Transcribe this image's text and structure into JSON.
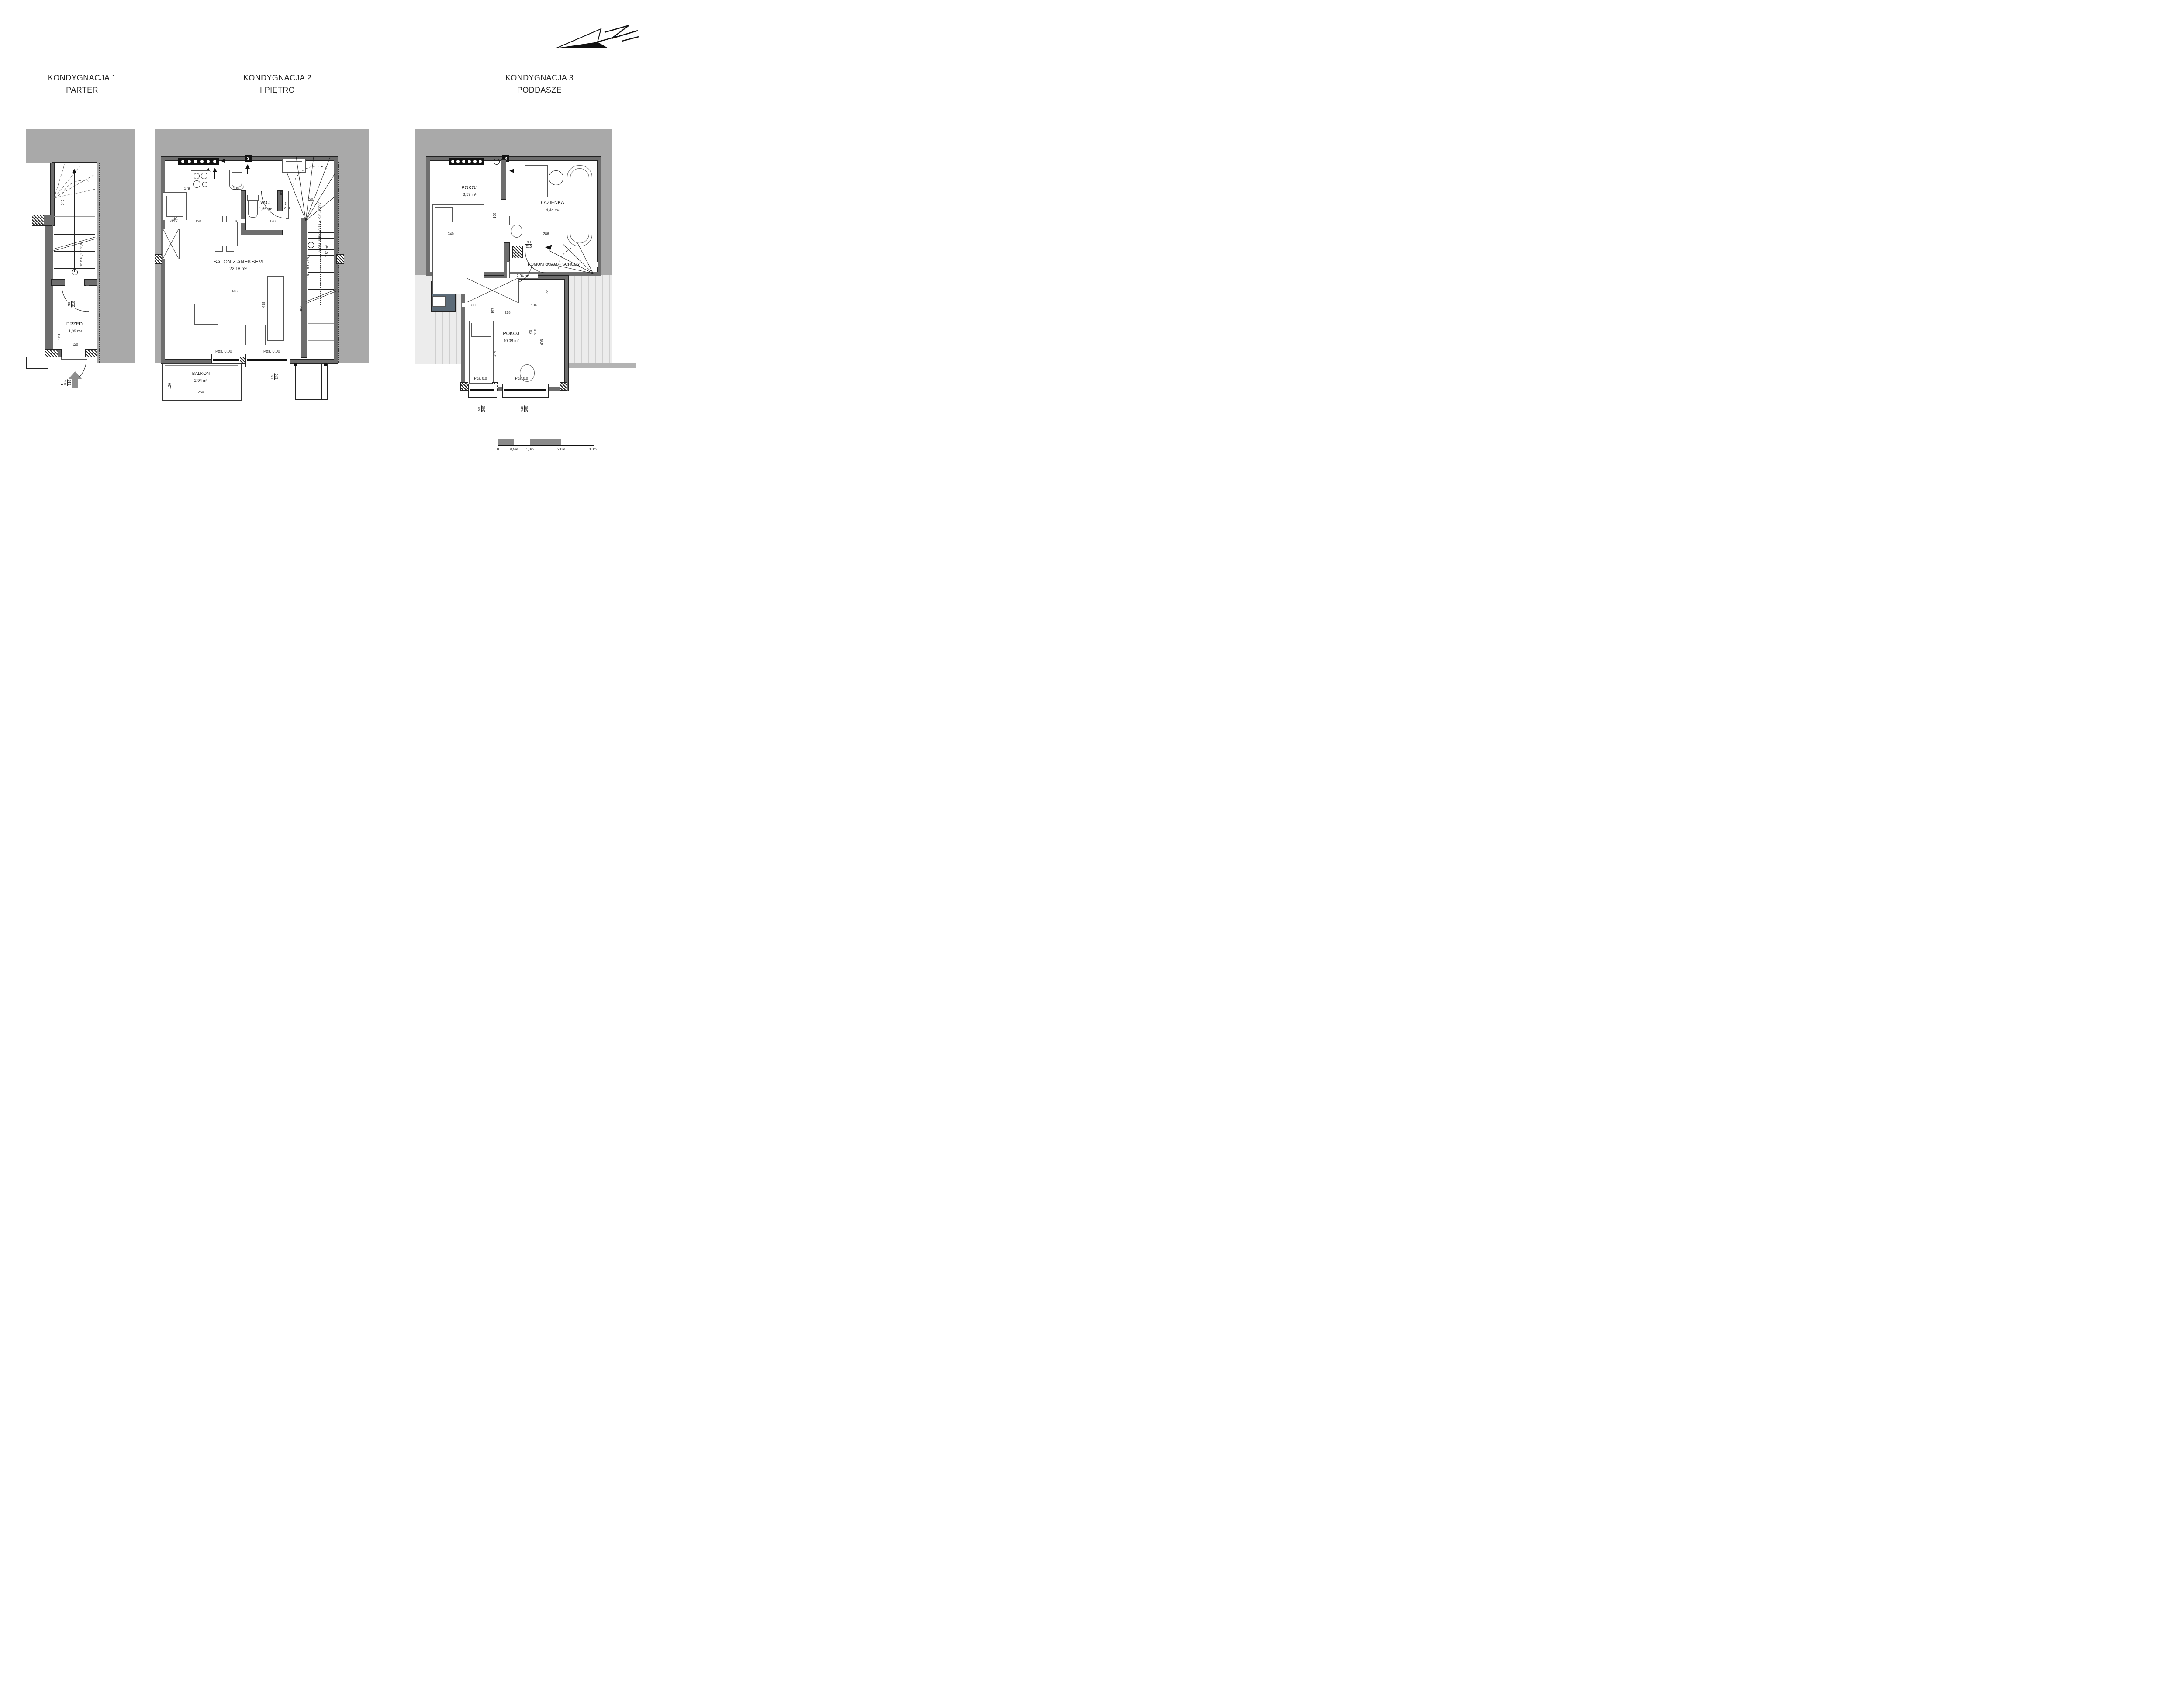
{
  "colors": {
    "neighbor_gray": "#a9a9a9",
    "wall_gray": "#6e6e6e",
    "roof_gray": "#ececec",
    "accent_slate": "#5c6b78"
  },
  "icons": {
    "heater_glyph": "✳"
  },
  "floor1": {
    "title_line1": "KONDYGNACJA 1",
    "title_line2": "PARTER",
    "room": {
      "name": "PRZED.",
      "area": "1,39 m²"
    },
    "dims": {
      "door_top_num": "90",
      "door_top_den": "210",
      "room_width": "120",
      "room_height": "120",
      "entry_num": "105",
      "entry_den": "210",
      "stair_run": "16 x 18,1 x 23,8",
      "stair_width": "140"
    }
  },
  "floor2": {
    "title_line1": "KONDYGNACJA 2",
    "title_line2": "I PIĘTRO",
    "section_marker": "3",
    "rooms": {
      "wc": {
        "name": "W.C.",
        "area": "1,56 m²"
      },
      "salon": {
        "name": "SALON Z ANEKSEM",
        "area": "22,18 m²"
      },
      "komunikacja": {
        "name": "KOMUNIKACJA + SCHODY",
        "area": "7,51 m²"
      },
      "balkon": {
        "name": "BALKON",
        "area": "2,94 m²"
      }
    },
    "level_note": "Pos. 0,00",
    "dims": {
      "kitchen": "179",
      "sink": "100",
      "top_right": "120",
      "wc_door_num": "90",
      "wc_door_den": "210",
      "wc_side": "160",
      "row": [
        "60",
        "120",
        "116",
        "120"
      ],
      "salon_width": "416",
      "salon_depth": "387",
      "table": "459",
      "stair_run": "16 x 18,1 x 23,8",
      "balkon_width": "250",
      "balkon_depth": "120",
      "door_win_num": "90",
      "door_win_den": "240",
      "win_num": "140",
      "win_den": "240"
    }
  },
  "floor3": {
    "title_line1": "KONDYGNACJA 3",
    "title_line2": "PODDASZE",
    "section_marker": "3",
    "rooms": {
      "pokoj1": {
        "name": "POKÓJ",
        "area": "8,59 m²"
      },
      "lazienka": {
        "name": "ŁAZIENKA",
        "area": "4,44 m²"
      },
      "komunikacja": {
        "name": "KOMUNIKACJA + SCHODY",
        "area": "7,04 m²"
      },
      "pokoj2": {
        "name": "POKÓJ",
        "area": "10,08 m²"
      }
    },
    "level_note": "Pos. 0,0",
    "dims": {
      "bed_width": "340",
      "mid_height": "168",
      "bath_width": "286",
      "door1_num": "90",
      "door1_den": "210",
      "corridor_1": "300",
      "corridor_2": "106",
      "v1": "135",
      "v2": "197",
      "door2_num": "90",
      "door2_den": "210",
      "door3_num": "90",
      "door3_den": "210",
      "lower_width": "278",
      "lower_height": "406",
      "bed2_height": "344",
      "win1_num": "90",
      "win1_den": "200",
      "win2_num": "140",
      "win2_den": "200"
    }
  },
  "scale_bar": {
    "labels": [
      "0",
      "0,5m",
      "1,0m",
      "2,0m",
      "3,0m"
    ]
  }
}
